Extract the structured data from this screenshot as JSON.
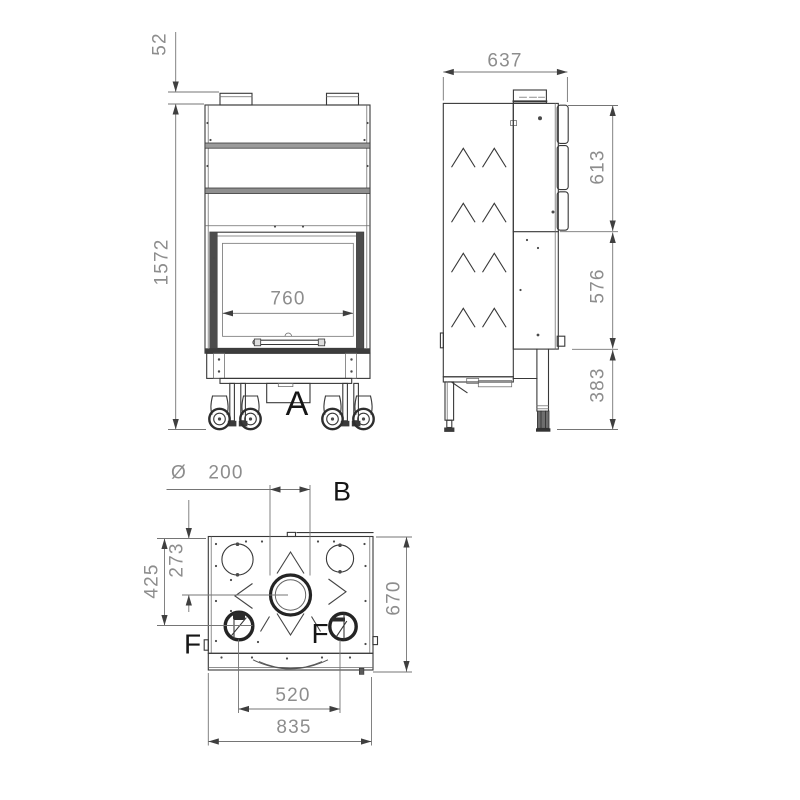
{
  "drawing_type": "fireplace-insert-technical-drawing",
  "colors": {
    "background": "#ffffff",
    "line": "#383838",
    "dimension_line": "#757575",
    "dimension_text": "#8d8d8d",
    "label_text": "#161616"
  },
  "views": {
    "front": {
      "labels": {
        "section_a": "A"
      },
      "dims": {
        "top_collar_height": "52",
        "total_height": "1572",
        "glass_width": "760"
      }
    },
    "side": {
      "dims": {
        "depth": "637",
        "upper_section": "613",
        "middle_section": "576",
        "base_section": "383"
      }
    },
    "plan": {
      "labels": {
        "flue": "B",
        "fan_left": "F",
        "fan_right": "F"
      },
      "dims": {
        "diameter_symbol": "Ø",
        "flue_diameter": "200",
        "flue_offset_from_back": "273",
        "fan_offset_from_back": "425",
        "depth": "670",
        "fan_spacing": "520",
        "overall_width": "835"
      }
    }
  }
}
